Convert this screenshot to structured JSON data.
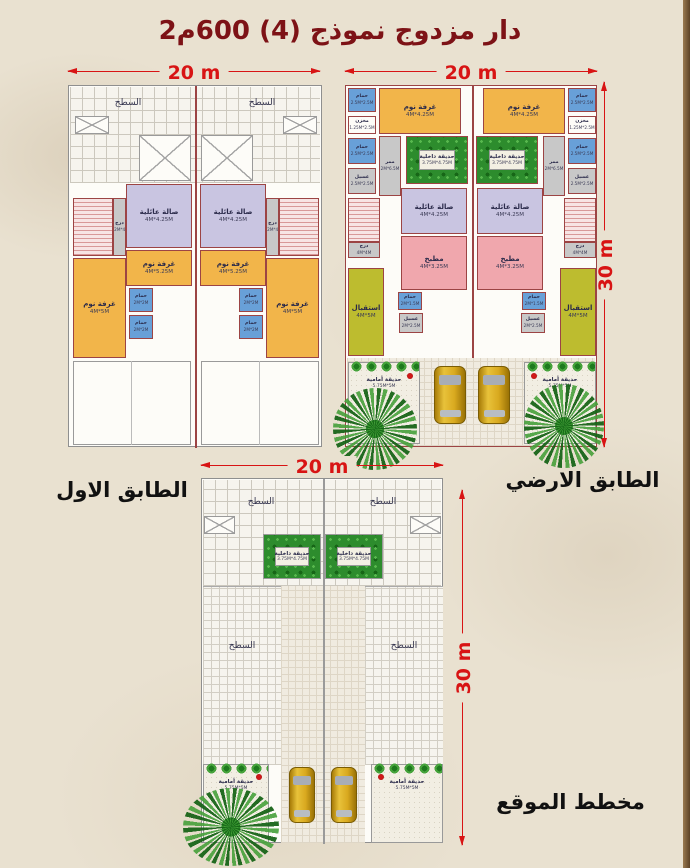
{
  "title": "دار مزدوج نموذج (4) 600م2",
  "floor_labels": {
    "first": "الطابق الاول",
    "ground": "الطابق الارضي",
    "site": "مخطط الموقع"
  },
  "dims": {
    "w": "20 m",
    "h": "30 m"
  },
  "colors": {
    "paper": "#e9e1d0",
    "title": "#7d1216",
    "dimension_red": "#d81414",
    "wall": "#9c4444",
    "bedroom": "#f2b54a",
    "family_hall": "#c9c5e1",
    "bath": "#68a0d8",
    "kitchen": "#f0a7ad",
    "reception": "#bdbc2f",
    "corridor_gray": "#c8c8c8",
    "garden_green": "#2d8c2d",
    "car_gold": "#d9a91f"
  },
  "rooms": {
    "roof": "السطح",
    "family_hall": {
      "name": "صالة عائلية",
      "size": "4M*4.25M"
    },
    "bedroom_mid": {
      "name": "غرفة نوم",
      "size": "4M*5.25M"
    },
    "bedroom_side": {
      "name": "غرفة نوم",
      "size": "4M*5M"
    },
    "bedroom_ground": {
      "name": "غرفة نوم",
      "size": "4M*4.25M"
    },
    "bath2": {
      "name": "حمام",
      "size": "2M*2M"
    },
    "bath25": {
      "name": "حمام",
      "size": "2.5M*2.5M"
    },
    "store": {
      "name": "مخزن",
      "size": "1.25M*2.5M"
    },
    "laundry": {
      "name": "غسيل",
      "size": "2.5M*2.5M"
    },
    "corridor": {
      "name": "ممر",
      "size": "2M*6.5M"
    },
    "stair_strip": {
      "name": "درج",
      "size": "1.2M*4M"
    },
    "stair_ground": {
      "name": "درج",
      "size": "4M*4M"
    },
    "garden_inner": {
      "name": "حديقة داخلية",
      "size": "3.75M*4.75M"
    },
    "kitchen": {
      "name": "مطبخ",
      "size": "4M*3.25M"
    },
    "reception": {
      "name": "استقبال",
      "size": "4M*5M"
    },
    "wc_small": {
      "name": "حمام",
      "size": "2M*1.5M"
    },
    "wash_small": {
      "name": "غسيل",
      "size": "2M*2.5M"
    },
    "garden_front": {
      "name": "حديقة أمامية",
      "size": "5.75M*5M"
    }
  }
}
